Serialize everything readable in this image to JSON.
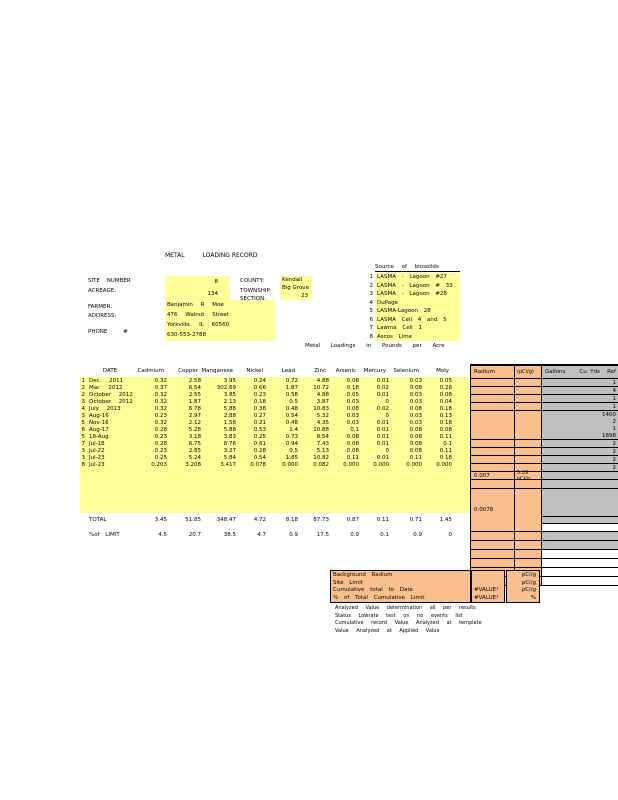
{
  "title": {
    "left": "METAL",
    "right": "LOADING RECORD"
  },
  "site": {
    "site_number_label": "SITE NUMBER",
    "site_number": "8",
    "acreage_label": "ACREAGE:",
    "acreage": "134",
    "farmer_label": "FARMER:",
    "address_label": "ADDRESS:",
    "phone_label": "PHONE #",
    "farmer_name": "Benjamin R Moe",
    "address_line1": "476 Walnut Street",
    "address_line2": "Yorkville, IL 60560",
    "phone_number": "630-553-2788",
    "county_label": "COUNTY:",
    "county": "Kendall",
    "township_label": "TOWNSHIP:",
    "township": "Big Grove",
    "section_label": "SECTION:",
    "section": "23"
  },
  "sources": {
    "header": "Source of biosolids",
    "items": [
      {
        "num": "1",
        "text": "LASMA - Lagoon #27"
      },
      {
        "num": "2",
        "text": "LASMA - Lagoon # 33"
      },
      {
        "num": "3",
        "text": "LASMA - Lagoon #28"
      },
      {
        "num": "4",
        "text": "DuPage"
      },
      {
        "num": "5",
        "text": "LASMA-Lagoon 28"
      },
      {
        "num": "6",
        "text": "LASMA Cell 4 and 5"
      },
      {
        "num": "7",
        "text": "Lawma Cell 1"
      },
      {
        "num": "8",
        "text": "Ascos Lime"
      }
    ]
  },
  "caption": "Metal Loadings in Pounds per Acre",
  "table": {
    "metal_columns": [
      "DATE",
      "Cadmium",
      "Copper",
      "Manganese",
      "Nickel",
      "Lead",
      "Zinc",
      "Arsenic",
      "Mercury",
      "Selenium",
      "Moly"
    ],
    "radium_label": "Radium",
    "radium_unit_label": "(pCi/g)",
    "gallons_label": "Gallons",
    "cuyds_label": "Cu. Yds",
    "ref_label": "Ref",
    "rows": [
      {
        "src": "1",
        "date": "Dec. 2011",
        "v": [
          "0.32",
          "2.58",
          "3.95",
          "0.24",
          "0.72",
          "4.88",
          "0.08",
          "0.01",
          "0.03",
          "0.05"
        ],
        "ref": "1"
      },
      {
        "src": "2",
        "date": "Mar. 2012",
        "v": [
          "0.37",
          "6.54",
          "302.69",
          "0.66",
          "1.87",
          "10.72",
          "0.18",
          "0.02",
          "0.08",
          "0.28"
        ],
        "ref": "4"
      },
      {
        "src": "2",
        "date": "October 2012",
        "v": [
          "0.32",
          "2.55",
          "3.85",
          "0.23",
          "0.58",
          "4.88",
          "0.05",
          "0.01",
          "0.03",
          "0.08"
        ],
        "ref": "1"
      },
      {
        "src": "3",
        "date": "October 2012",
        "v": [
          "0.32",
          "1.87",
          "2.13",
          "0.18",
          "0.5",
          "3.87",
          "0.03",
          "0",
          "0.03",
          "0.04"
        ],
        "ref": "1"
      },
      {
        "src": "4",
        "date": "July 2013",
        "v": [
          "0.32",
          "6.78",
          "5.88",
          "0.38",
          "0.48",
          "10.83",
          "0.08",
          "0.02",
          "0.08",
          "0.18"
        ],
        "ref": "1400"
      },
      {
        "src": "3",
        "date": "Aug-16",
        "v": [
          "0.23",
          "2.97",
          "2.88",
          "0.27",
          "0.54",
          "5.32",
          "0.03",
          "0",
          "0.03",
          "0.13"
        ],
        "ref": "2"
      },
      {
        "src": "5",
        "date": "Nov-16",
        "v": [
          "0.32",
          "2.12",
          "1.58",
          "0.21",
          "0.48",
          "4.35",
          "0.03",
          "0.01",
          "0.03",
          "0.18"
        ],
        "ref": "1"
      },
      {
        "src": "6",
        "date": "Aug-17",
        "v": [
          "0.28",
          "5.28",
          "5.88",
          "0.53",
          "1.4",
          "10.88",
          "0.1",
          "0.01",
          "0.08",
          "0.08"
        ],
        "ref": "1898"
      },
      {
        "src": "5",
        "date": "18-Aug",
        "v": [
          "0.23",
          "3.18",
          "3.83",
          "0.25",
          "0.73",
          "8.54",
          "0.08",
          "0.01",
          "0.08",
          "0.11"
        ],
        "ref": "2"
      },
      {
        "src": "7",
        "date": "Jul-18",
        "v": [
          "0.28",
          "6.75",
          "8.76",
          "0.61",
          "0.94",
          "7.43",
          "0.08",
          "0.01",
          "0.08",
          "0.1"
        ],
        "ref": "2"
      },
      {
        "src": "3",
        "date": "Jul-22",
        "v": [
          "0.23",
          "2.85",
          "3.27",
          "0.28",
          "0.5",
          "5.13",
          "0.08",
          "0",
          "0.08",
          "0.11"
        ],
        "ref": "2"
      },
      {
        "src": "3",
        "date": "Jul-23",
        "v": [
          "0.25",
          "5.24",
          "5.84",
          "0.54",
          "1.85",
          "10.82",
          "0.11",
          "0.01",
          "0.11",
          "0.18"
        ],
        "ref": "2"
      },
      {
        "src": "8",
        "date": "Jul-23",
        "v": [
          "0.203",
          "3.208",
          "3.417",
          "0.078",
          "0.000",
          "0.082",
          "0.000",
          "0.000",
          "0.000",
          "0.000"
        ],
        "ref": "",
        "radium": "0.007",
        "radium_note": "5.39",
        "radium_note_unit": "pCi/g"
      }
    ],
    "total_label": "TOTAL",
    "total": [
      "3.45",
      "51.85",
      "348.47",
      "4.72",
      "8.18",
      "87.73",
      "0.87",
      "0.11",
      "0.71",
      "1.45"
    ],
    "pct_label": "%of LIMIT",
    "pct": [
      "4.5",
      "20.7",
      "38.5",
      "4.7",
      "0.9",
      "17.5",
      "0.9",
      "0.1",
      "0.9",
      "0"
    ],
    "cumulative_radium": "0.0078"
  },
  "bottom": {
    "rows": [
      {
        "label": "Background Radium",
        "value": "",
        "unit": "pCi/g"
      },
      {
        "label": "Site Limit",
        "value": "",
        "unit": "pCi/g"
      },
      {
        "label": "Cumulative total to Date",
        "value": "#VALUE!",
        "unit": "pCi/g"
      },
      {
        "label": "% of Total Cumulative Limit",
        "value": "#VALUE!",
        "unit": "%"
      }
    ],
    "notes": [
      "Analyzed Value determination all per results",
      "Status Lowrate test on no events list",
      "Cumulative record Value Analyzed at template",
      "Value Analyzed at Applied Value"
    ]
  },
  "colors": {
    "yellow": "#FFFF99",
    "orange": "#FABF8F",
    "gray": "#C0C0C0"
  }
}
